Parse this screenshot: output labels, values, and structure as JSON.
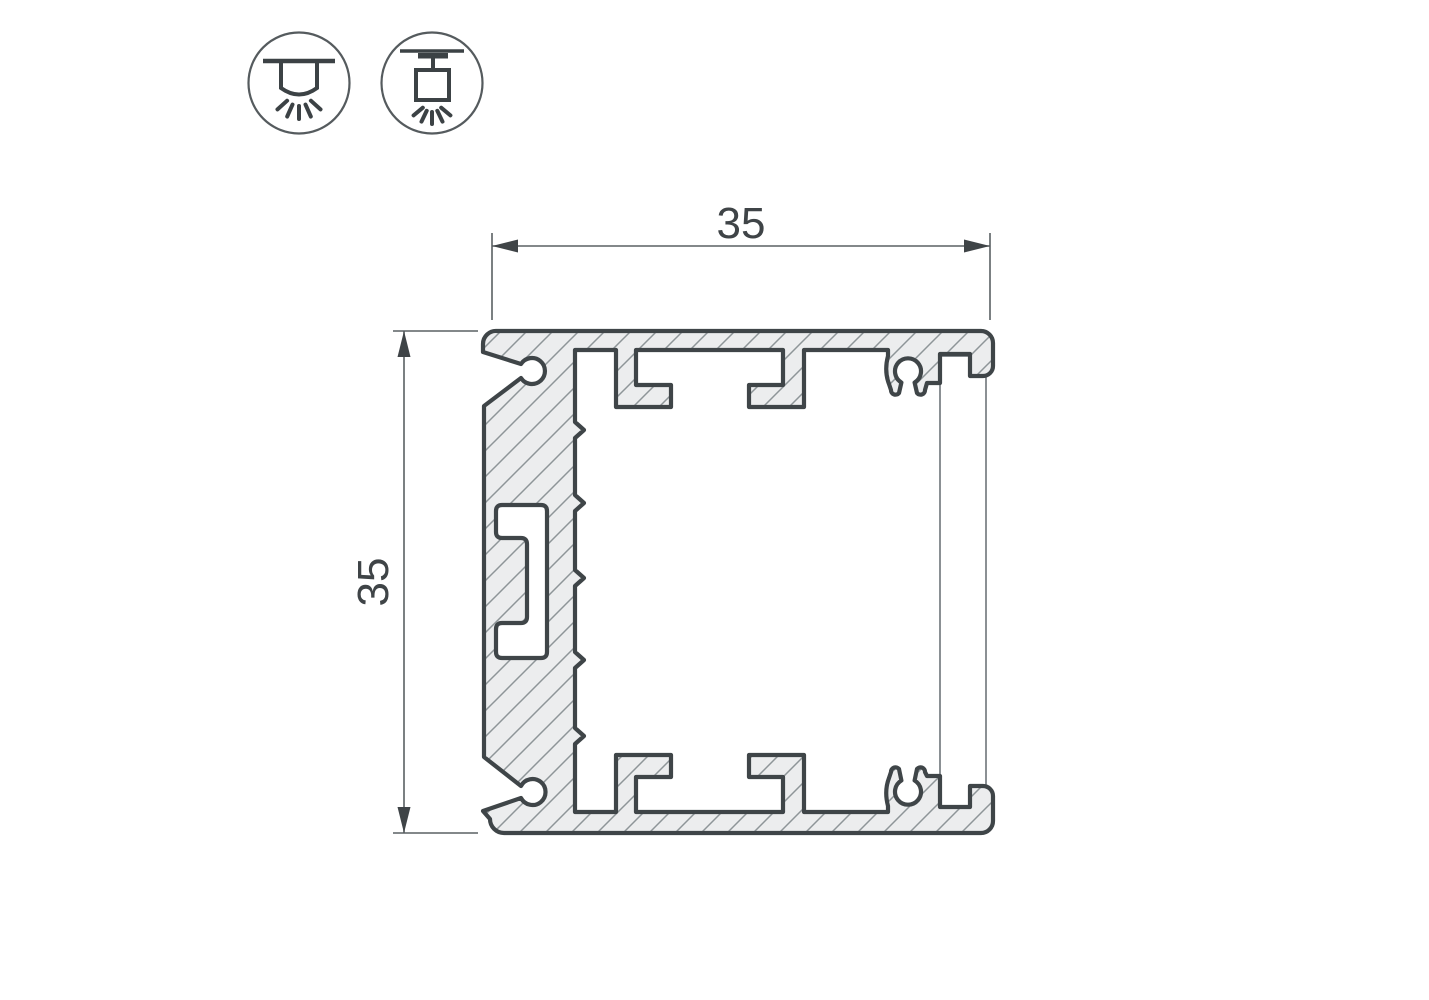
{
  "drawing": {
    "type": "technical-cross-section",
    "subject": "aluminium LED profile 35x35, sectional view with hatching and diffuser",
    "dimension_horizontal": {
      "label": "35"
    },
    "dimension_vertical": {
      "label": "35"
    },
    "icons": [
      {
        "name": "surface-mount-light-icon",
        "meaning": "surface ceiling mounting"
      },
      {
        "name": "pendant-mount-light-icon",
        "meaning": "suspended / pendant mounting"
      }
    ],
    "colors": {
      "background": "#ffffff",
      "outline_bold": "#3f4548",
      "hatch_line": "#8e9598",
      "aluminium_fill": "#ecedee",
      "thin_line": "#5a6063",
      "dimension_text": "#3f4447",
      "icon_stroke": "#3c4245"
    }
  }
}
